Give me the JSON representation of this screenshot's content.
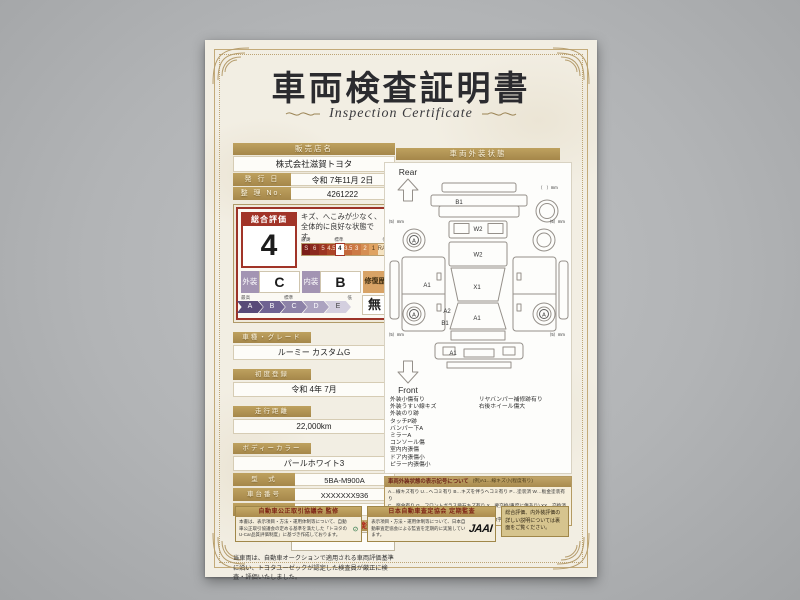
{
  "page": {
    "title": "車両検査証明書",
    "subtitle": "Inspection Certificate"
  },
  "dealer": {
    "name_label": "販売店名",
    "name": "株式会社滋賀トヨタ",
    "issue_label": "発 行 日",
    "issue_date": "令和 7年11月 2日",
    "ref_label": "整 理 No.",
    "ref_no": "4261222"
  },
  "evaluation": {
    "overall_label": "総合評価",
    "overall_grade": "4",
    "comment": "キズ、へこみが少なく、全体的に良好な状態です。",
    "scale_labels": {
      "best": "最高",
      "standard": "標準",
      "low": "低"
    },
    "grade_scale": [
      {
        "label": "S",
        "bg": "#7b1d18",
        "color": "#f2ded0"
      },
      {
        "label": "6",
        "bg": "#8c2a1e",
        "color": "#f2ded0"
      },
      {
        "label": "5",
        "bg": "#9c3522",
        "color": "#f2ded0"
      },
      {
        "label": "4.5",
        "bg": "#ac4527",
        "color": "#f6e4d2"
      },
      {
        "label": "4",
        "bg": "#ffffff",
        "color": "#222222",
        "highlight": true
      },
      {
        "label": "3.5",
        "bg": "#c4693b",
        "color": "#fff6ea"
      },
      {
        "label": "3",
        "bg": "#cc7a45",
        "color": "#fff6ea"
      },
      {
        "label": "2",
        "bg": "#d58e52",
        "color": "#fff6ea"
      },
      {
        "label": "1",
        "bg": "#dfa362",
        "color": "#503416"
      },
      {
        "label": "RA/R",
        "bg": "#f4e3c2",
        "color": "#6b4b2a"
      }
    ],
    "exterior_label": "外装",
    "exterior_grade": "C",
    "interior_label": "内装",
    "interior_grade": "B",
    "repair_label": "修復歴",
    "repair_value": "無",
    "letter_scale": [
      {
        "label": "A",
        "bg": "#584a78",
        "color": "#ffffff"
      },
      {
        "label": "B",
        "bg": "#6f6292",
        "color": "#ffffff"
      },
      {
        "label": "C",
        "bg": "#8d82a8",
        "color": "#ffffff"
      },
      {
        "label": "D",
        "bg": "#aca3c0",
        "color": "#ffffff"
      },
      {
        "label": "E",
        "bg": "#d4cfdf",
        "color": "#444444"
      }
    ]
  },
  "vehicle": {
    "rows_stacked": [
      {
        "label": "車種・グレード",
        "value": "ルーミー カスタムG"
      },
      {
        "label": "初度登録",
        "value": "令和 4年 7月"
      },
      {
        "label": "走行距離",
        "value": "22,000km"
      },
      {
        "label": "ボディーカラー",
        "value": "パールホワイト3"
      }
    ],
    "rows_inline": [
      {
        "label": "型　式",
        "value": "5BA-M900A"
      },
      {
        "label": "車台番号",
        "value": "XXXXXXX936"
      },
      {
        "label": "エンジン",
        "value": "ガソリン"
      }
    ]
  },
  "inspector": {
    "brand": "TOYOTA",
    "cert_label": "トヨタ認定車両検査員"
  },
  "disclaimer": "当車両は、自動車オークションで適用される車両評価基準に沿い、トヨタユーゼックが認定した検査員が厳正に検査・評価いたしました。",
  "exterior_panel": {
    "header": "車両外装状態",
    "rear_label": "Rear",
    "front_label": "Front",
    "marks": {
      "rear_gate": "B1",
      "rear_window": "W2",
      "roof": "W2",
      "center": "X1",
      "left_side": "A1",
      "front_left_fender": "A2",
      "front_left_lower": "B1",
      "windshield": "A1",
      "front_bumper": "A1",
      "wheel": "A",
      "tread_5mm": "〔5〕mm",
      "tread_blank": "〔　〕mm"
    },
    "notes_left": [
      "外装小傷有り",
      "外装うすい線キズ",
      "外装のり跡",
      "タッチP跡",
      "バンパー下A",
      "ミラーA",
      "コンソール傷",
      "室内内張傷",
      "ドア内張傷小",
      "ピラー内張傷小"
    ],
    "notes_right": [
      "リヤバンパー補修跡有り",
      "右後ホイール傷大"
    ]
  },
  "symbol_legend": {
    "title": "車両外装状態の表示記号について",
    "example": "(例)A1…線キズ小(程度有り)",
    "lines": [
      "A…線キズ有り U…ヘコミ有り B…キズを伴うヘコミ有り P…塗装済 W…板金塗装有り",
      "C…腐食有り G…フロントガラス飛石キズ有り X…要交換(重度に傷あり) XX…交換済有り",
      "1…小程度 2…中程度 3…中程度以上 ※マーク右の数字は程度を表示しています"
    ]
  },
  "footer": {
    "badge1": {
      "title": "自動車公正取引協議会 監修",
      "body": "本書は、表示項目・方法・運用体制等について、自動車公正取引協議会の定める基準を満たした「トヨタのU-Car品質評価制度」に基づき作成しております。"
    },
    "badge2": {
      "title": "日本自動車査定協会 定期監査",
      "body": "表示項目・方法・運用体制等について、日本自動車査定協会による監査を定期的に実施しています。",
      "logo": "JAAI"
    },
    "note": "総合評価、内外装評価の詳しい説明については裏面をご覧ください。"
  }
}
